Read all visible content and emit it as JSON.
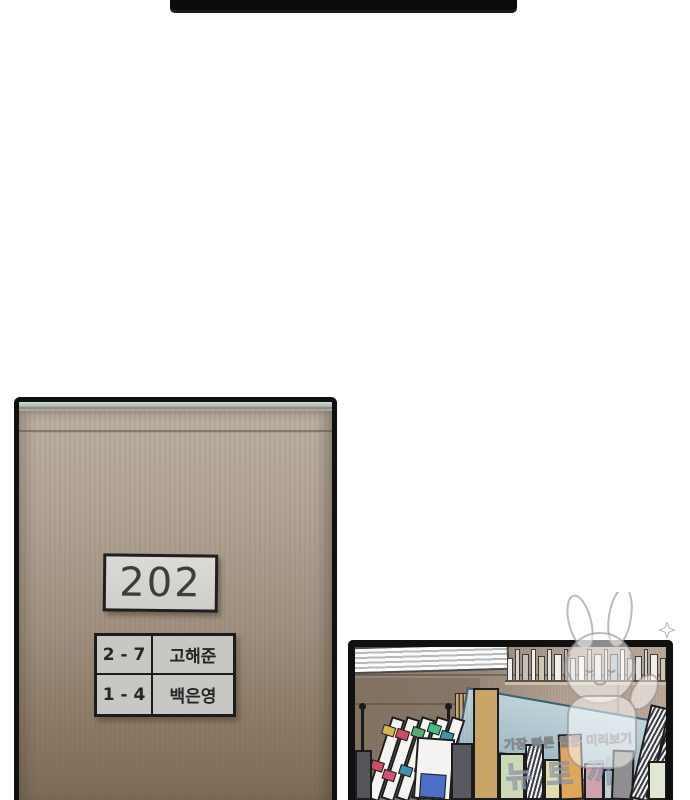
{
  "page": {
    "type": "webtoon-comic-page",
    "background": "#ffffff"
  },
  "top_panel": {
    "description": "bottom edge of previous comic panel",
    "color": "#0b0b0b"
  },
  "door_panel": {
    "sign_number": "202",
    "nameplate": {
      "rows": [
        {
          "class_no": "2 - 7",
          "name": "고해준"
        },
        {
          "class_no": "1 - 4",
          "name": "백은영"
        }
      ]
    },
    "colors": {
      "outline": "#101010",
      "top_strip": "#a9bcb0",
      "door_top": "#bcb0a4",
      "door_bottom": "#7b6a56",
      "sign_bg": "#d6d4d1",
      "plate_bg": "#c9c7c3",
      "text": "#262626"
    }
  },
  "desk_panel": {
    "watermark": {
      "line1": "가장 빠른 웹툰 미리보기",
      "line2": "뉴토끼",
      "mascot": "rabbit-eared chibi character, semi-transparent white"
    },
    "colors": {
      "wall_left": "#90806e",
      "wall_right": "#bcab9c",
      "acrylic_board": "#a6c2ce",
      "acrylic_edge": "#3a607a",
      "outline": "#1c1c1c"
    },
    "shelf_spines": [
      {
        "w": 6,
        "c": "#f0efec"
      },
      {
        "w": 5,
        "c": "#d8d5d0"
      },
      {
        "w": 8,
        "c": "#c4c0ba"
      },
      {
        "w": 5,
        "c": "#f0efec"
      },
      {
        "w": 7,
        "c": "#cfc6b4"
      },
      {
        "w": 5,
        "c": "#e4e2de"
      },
      {
        "w": 8,
        "c": "#f0efec"
      },
      {
        "w": 5,
        "c": "#c4c0ba"
      },
      {
        "w": 6,
        "c": "#d8d5d0"
      },
      {
        "w": 7,
        "c": "#f0efec"
      },
      {
        "w": 5,
        "c": "#cfc6b4"
      },
      {
        "w": 8,
        "c": "#e4e2de"
      },
      {
        "w": 5,
        "c": "#d8d5d0"
      },
      {
        "w": 8,
        "c": "#9fb6c8"
      },
      {
        "w": 5,
        "c": "#f0efec"
      },
      {
        "w": 6,
        "c": "#c4c0ba"
      },
      {
        "w": 7,
        "c": "#e4e2de"
      },
      {
        "w": 5,
        "c": "#d8d5d0"
      },
      {
        "w": 8,
        "c": "#f0efec"
      },
      {
        "w": 6,
        "c": "#cfc6b4"
      }
    ],
    "bottom_books": [
      {
        "x": 0,
        "w": 17,
        "h": 50,
        "c": "#54555b"
      },
      {
        "x": 96,
        "w": 22,
        "h": 57,
        "c": "#585a60"
      },
      {
        "x": 118,
        "w": 26,
        "h": 112,
        "c": "#c9a56a"
      },
      {
        "x": 144,
        "w": 26,
        "h": 47,
        "c": "#cdd8b6"
      },
      {
        "x": 170,
        "w": 19,
        "h": 56,
        "c": "hatched"
      },
      {
        "x": 189,
        "w": 17,
        "h": 41,
        "c": "#e5dcab"
      },
      {
        "x": 205,
        "w": 24,
        "h": 66,
        "c": "#dfa75c",
        "tilt": -2
      },
      {
        "x": 229,
        "w": 20,
        "h": 37,
        "c": "#cfa2ac"
      },
      {
        "x": 248,
        "w": 16,
        "h": 31,
        "c": "#c3cdd5"
      },
      {
        "x": 256,
        "w": 22,
        "h": 50,
        "c": "#8f8f91",
        "tilt": 2
      },
      {
        "x": 274,
        "w": 20,
        "h": 96,
        "c": "hatched",
        "tilt": 13
      },
      {
        "x": 290,
        "w": 18,
        "h": 102,
        "c": "hatched",
        "tilt": 17
      },
      {
        "x": 293,
        "w": 20,
        "h": 39,
        "c": "#e0e8d3"
      },
      {
        "x": 310,
        "w": 14,
        "h": 44,
        "c": "#f2f1ee"
      }
    ],
    "rack_files": [
      {
        "dx": 8,
        "tabs": [
          {
            "c": "#d8b84e",
            "t": 8
          },
          {
            "c": "#c94f62",
            "t": 45
          }
        ]
      },
      {
        "dx": 23,
        "tabs": [
          {
            "c": "#c94f62",
            "t": 12
          },
          {
            "c": "#cc5577",
            "t": 55
          }
        ]
      },
      {
        "dx": 38,
        "tabs": [
          {
            "c": "#57a877",
            "t": 10
          },
          {
            "c": "#3f93ad",
            "t": 50
          }
        ]
      },
      {
        "dx": 53,
        "tabs": [
          {
            "c": "#4db885",
            "t": 6
          },
          {
            "c": "#c94f62",
            "t": 48
          }
        ]
      },
      {
        "dx": 68,
        "tabs": [
          {
            "c": "#3f93ad",
            "t": 14
          },
          {
            "c": "#4a6fc4",
            "t": 58
          }
        ]
      }
    ]
  }
}
